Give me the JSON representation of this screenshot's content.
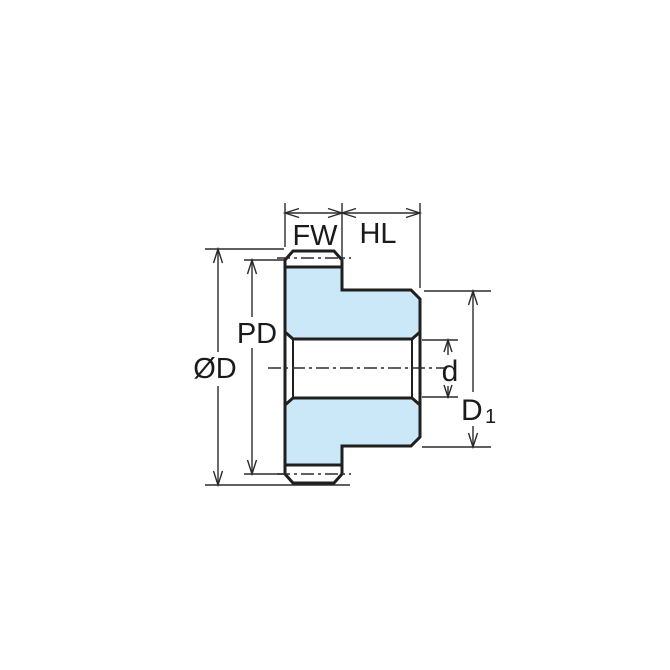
{
  "diagram": {
    "title": "Spur gear cross-section dimension drawing",
    "labels": {
      "face_width": "FW",
      "hub_length": "HL",
      "pitch_diameter": "PD",
      "outer_diameter": "ØD",
      "bore_diameter": "d",
      "hub_diameter_main": "D",
      "hub_diameter_sub": "1"
    },
    "colors": {
      "body_fill": "#CAE8F7",
      "line": "#1F1F1F",
      "background": "#FFFFFF"
    }
  }
}
